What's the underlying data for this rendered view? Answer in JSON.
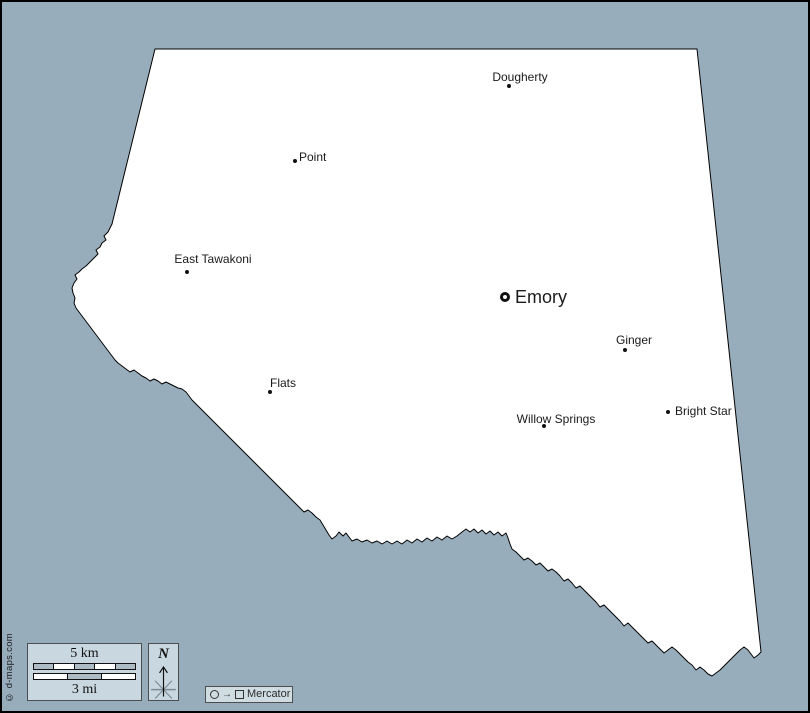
{
  "colors": {
    "water_background": "#98ADBC",
    "county_fill": "#FFFFFF",
    "county_border": "#000000",
    "panel_fill": "#C9D8E0",
    "panel_border": "#4D4D4D",
    "scale_segment_gray": "#ADBCC4",
    "scale_segment_white": "#FFFFFF",
    "label_text": "#1A1A1A"
  },
  "map": {
    "outline_points": [
      [
        153,
        47
      ],
      [
        695,
        47
      ],
      [
        759,
        650
      ],
      [
        756,
        653
      ],
      [
        752,
        656
      ],
      [
        749,
        652
      ],
      [
        746,
        648
      ],
      [
        742,
        645
      ],
      [
        738,
        648
      ],
      [
        734,
        652
      ],
      [
        730,
        656
      ],
      [
        726,
        660
      ],
      [
        722,
        664
      ],
      [
        718,
        668
      ],
      [
        714,
        671
      ],
      [
        710,
        674
      ],
      [
        706,
        672
      ],
      [
        702,
        668
      ],
      [
        698,
        665
      ],
      [
        694,
        668
      ],
      [
        690,
        663
      ],
      [
        686,
        660
      ],
      [
        682,
        656
      ],
      [
        678,
        652
      ],
      [
        674,
        648
      ],
      [
        670,
        645
      ],
      [
        666,
        648
      ],
      [
        662,
        651
      ],
      [
        658,
        647
      ],
      [
        654,
        643
      ],
      [
        650,
        639
      ],
      [
        646,
        641
      ],
      [
        642,
        637
      ],
      [
        638,
        633
      ],
      [
        634,
        629
      ],
      [
        630,
        625
      ],
      [
        626,
        621
      ],
      [
        622,
        624
      ],
      [
        618,
        619
      ],
      [
        614,
        615
      ],
      [
        610,
        611
      ],
      [
        606,
        607
      ],
      [
        602,
        603
      ],
      [
        598,
        605
      ],
      [
        594,
        600
      ],
      [
        590,
        596
      ],
      [
        586,
        592
      ],
      [
        582,
        588
      ],
      [
        578,
        584
      ],
      [
        574,
        586
      ],
      [
        570,
        581
      ],
      [
        566,
        577
      ],
      [
        562,
        579
      ],
      [
        558,
        574
      ],
      [
        554,
        570
      ],
      [
        550,
        567
      ],
      [
        546,
        569
      ],
      [
        542,
        565
      ],
      [
        538,
        561
      ],
      [
        534,
        563
      ],
      [
        530,
        559
      ],
      [
        526,
        556
      ],
      [
        522,
        558
      ],
      [
        518,
        554
      ],
      [
        514,
        550
      ],
      [
        510,
        547
      ],
      [
        508,
        542
      ],
      [
        506,
        536
      ],
      [
        504,
        531
      ],
      [
        500,
        534
      ],
      [
        496,
        530
      ],
      [
        492,
        533
      ],
      [
        488,
        529
      ],
      [
        484,
        532
      ],
      [
        480,
        528
      ],
      [
        476,
        531
      ],
      [
        472,
        527
      ],
      [
        468,
        530
      ],
      [
        464,
        527
      ],
      [
        460,
        530
      ],
      [
        455,
        534
      ],
      [
        450,
        537
      ],
      [
        445,
        534
      ],
      [
        440,
        538
      ],
      [
        435,
        535
      ],
      [
        430,
        539
      ],
      [
        425,
        536
      ],
      [
        420,
        540
      ],
      [
        415,
        537
      ],
      [
        410,
        541
      ],
      [
        405,
        538
      ],
      [
        400,
        542
      ],
      [
        395,
        539
      ],
      [
        390,
        542
      ],
      [
        385,
        539
      ],
      [
        380,
        542
      ],
      [
        375,
        539
      ],
      [
        370,
        541
      ],
      [
        365,
        538
      ],
      [
        360,
        540
      ],
      [
        355,
        537
      ],
      [
        350,
        539
      ],
      [
        347,
        535
      ],
      [
        344,
        531
      ],
      [
        341,
        534
      ],
      [
        337,
        530
      ],
      [
        334,
        534
      ],
      [
        330,
        537
      ],
      [
        327,
        533
      ],
      [
        324,
        528
      ],
      [
        321,
        523
      ],
      [
        318,
        518
      ],
      [
        314,
        515
      ],
      [
        310,
        511
      ],
      [
        306,
        508
      ],
      [
        302,
        510
      ],
      [
        298,
        506
      ],
      [
        294,
        502
      ],
      [
        290,
        498
      ],
      [
        286,
        494
      ],
      [
        282,
        490
      ],
      [
        278,
        486
      ],
      [
        274,
        482
      ],
      [
        270,
        478
      ],
      [
        266,
        474
      ],
      [
        262,
        470
      ],
      [
        258,
        466
      ],
      [
        254,
        462
      ],
      [
        250,
        458
      ],
      [
        246,
        454
      ],
      [
        242,
        450
      ],
      [
        238,
        446
      ],
      [
        234,
        442
      ],
      [
        230,
        438
      ],
      [
        226,
        434
      ],
      [
        222,
        430
      ],
      [
        218,
        426
      ],
      [
        214,
        422
      ],
      [
        210,
        418
      ],
      [
        206,
        414
      ],
      [
        202,
        410
      ],
      [
        198,
        406
      ],
      [
        194,
        402
      ],
      [
        190,
        398
      ],
      [
        187,
        394
      ],
      [
        184,
        390
      ],
      [
        180,
        387
      ],
      [
        176,
        386
      ],
      [
        172,
        384
      ],
      [
        168,
        382
      ],
      [
        164,
        380
      ],
      [
        160,
        382
      ],
      [
        156,
        379
      ],
      [
        152,
        377
      ],
      [
        148,
        379
      ],
      [
        144,
        376
      ],
      [
        140,
        374
      ],
      [
        136,
        371
      ],
      [
        132,
        368
      ],
      [
        128,
        370
      ],
      [
        124,
        367
      ],
      [
        120,
        364
      ],
      [
        116,
        361
      ],
      [
        113,
        358
      ],
      [
        110,
        354
      ],
      [
        107,
        350
      ],
      [
        104,
        346
      ],
      [
        101,
        342
      ],
      [
        98,
        338
      ],
      [
        95,
        334
      ],
      [
        92,
        330
      ],
      [
        89,
        326
      ],
      [
        86,
        322
      ],
      [
        83,
        318
      ],
      [
        80,
        314
      ],
      [
        77,
        310
      ],
      [
        74,
        306
      ],
      [
        72,
        301
      ],
      [
        73,
        296
      ],
      [
        71,
        291
      ],
      [
        70,
        286
      ],
      [
        72,
        281
      ],
      [
        75,
        277
      ],
      [
        73,
        273
      ],
      [
        77,
        270
      ],
      [
        80,
        267
      ],
      [
        84,
        264
      ],
      [
        87,
        261
      ],
      [
        90,
        258
      ],
      [
        93,
        255
      ],
      [
        96,
        252
      ],
      [
        94,
        248
      ],
      [
        98,
        245
      ],
      [
        100,
        241
      ],
      [
        104,
        238
      ],
      [
        102,
        234
      ],
      [
        106,
        230
      ],
      [
        108,
        226
      ],
      [
        110,
        222
      ]
    ]
  },
  "places": [
    {
      "name": "Dougherty",
      "marker": "dot",
      "marker_x": 507,
      "marker_y": 84,
      "label_x": 518,
      "label_y": 75,
      "anchor": "center",
      "size": "small"
    },
    {
      "name": "Point",
      "marker": "dot",
      "marker_x": 293,
      "marker_y": 159,
      "label_x": 297,
      "label_y": 155,
      "anchor": "left",
      "size": "small"
    },
    {
      "name": "East Tawakoni",
      "marker": "dot",
      "marker_x": 185,
      "marker_y": 270,
      "label_x": 211,
      "label_y": 257,
      "anchor": "center",
      "size": "small"
    },
    {
      "name": "Emory",
      "marker": "ring",
      "marker_x": 503,
      "marker_y": 295,
      "label_x": 513,
      "label_y": 295,
      "anchor": "left",
      "size": "large"
    },
    {
      "name": "Ginger",
      "marker": "dot",
      "marker_x": 623,
      "marker_y": 348,
      "label_x": 632,
      "label_y": 338,
      "anchor": "center",
      "size": "small"
    },
    {
      "name": "Flats",
      "marker": "dot",
      "marker_x": 268,
      "marker_y": 390,
      "label_x": 281,
      "label_y": 381,
      "anchor": "center",
      "size": "small"
    },
    {
      "name": "Willow Springs",
      "marker": "dot",
      "marker_x": 542,
      "marker_y": 424,
      "label_x": 554,
      "label_y": 417,
      "anchor": "center",
      "size": "small"
    },
    {
      "name": "Bright Star",
      "marker": "dot",
      "marker_x": 666,
      "marker_y": 410,
      "label_x": 673,
      "label_y": 409,
      "anchor": "left",
      "size": "small"
    }
  ],
  "scale_bar": {
    "km_label": "5 km",
    "mi_label": "3 mi",
    "km_segment_colors": [
      "#ADBCC4",
      "#FFFFFF",
      "#ADBCC4",
      "#FFFFFF",
      "#ADBCC4"
    ],
    "mi_segment_colors": [
      "#FFFFFF",
      "#ADBCC4",
      "#FFFFFF"
    ]
  },
  "compass": {
    "north_label": "N"
  },
  "projection_legend": {
    "symbols": [
      "circle",
      "arrow-right",
      "square"
    ],
    "arrow_glyph": "→",
    "label": "Mercator"
  },
  "credit": {
    "text": "© d-maps.com"
  }
}
